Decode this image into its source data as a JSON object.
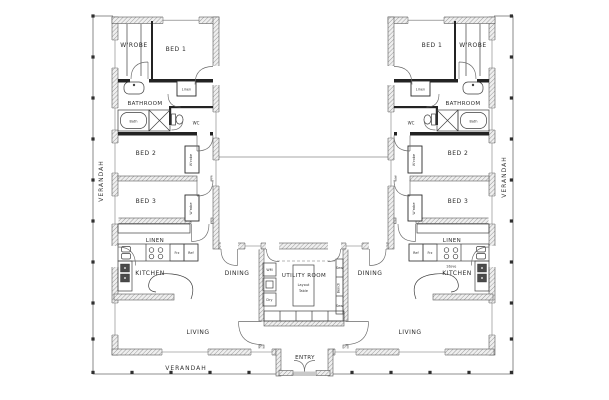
{
  "colors": {
    "paper": "#ffffff",
    "ink": "#2b2b2b",
    "wall_hatch": "#9a9a9a",
    "wall_fill": "#f0f0f0",
    "paving": "#c9c9c9"
  },
  "verandah": {
    "left": "VERANDAH",
    "right": "VERANDAH",
    "bottom": "VERANDAH"
  },
  "left_unit": {
    "wrobe": "W'ROBE",
    "bed1": "BED 1",
    "linen_small": "Linen",
    "bathroom": "BATHROOM",
    "bath": "Bath",
    "wc": "WC",
    "bed2": "BED 2",
    "bed2_wrobe": "W'robe",
    "bed3": "BED 3",
    "bed3_wrobe": "W'robe",
    "linen": "LINEN",
    "frz": "Frz",
    "ref": "Ref",
    "kitchen": "KITCHEN",
    "dining": "DINING",
    "living": "LIVING"
  },
  "right_unit": {
    "bed1": "BED 1",
    "wrobe": "W'ROBE",
    "linen_small": "Linen",
    "bathroom": "BATHROOM",
    "wc": "WC",
    "bath": "Bath",
    "bed2": "BED 2",
    "bed2_wrobe": "W'robe",
    "bed3": "BED 3",
    "bed3_wrobe": "W'robe",
    "linen": "LINEN",
    "ref": "Ref",
    "frz": "Frz",
    "stove": "Stove",
    "kitchen": "KITCHEN",
    "dining": "DINING",
    "living": "LIVING"
  },
  "utility_room": {
    "label": "UTILITY ROOM",
    "layout_word1": "Layout",
    "layout_word2": "Table",
    "wm": "WM",
    "dry": "Dry",
    "sew_upper": "Sew",
    "bench": "Bench",
    "sew_lower": "Sew"
  },
  "entry": {
    "label": "ENTRY"
  }
}
